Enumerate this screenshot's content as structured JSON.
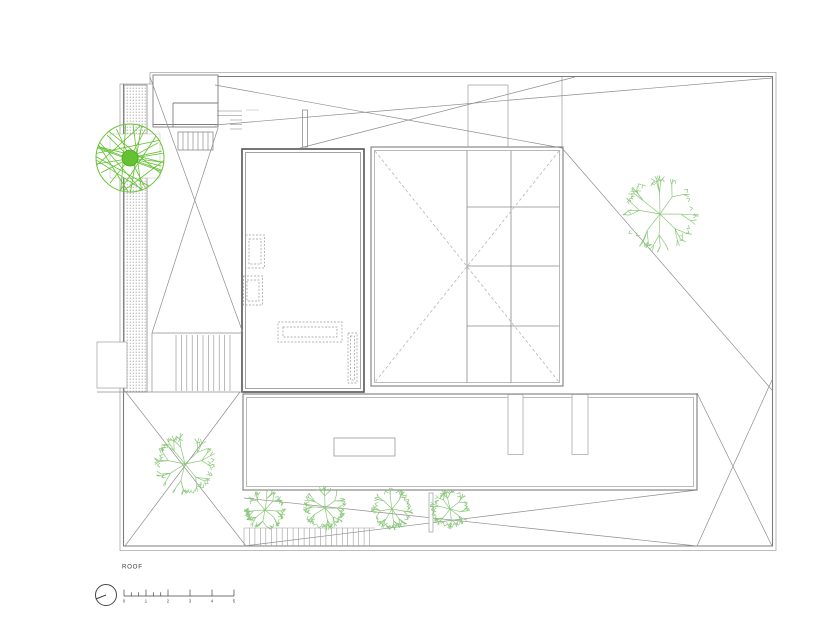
{
  "drawing": {
    "label": "ROOF"
  },
  "scale_bar": {
    "unit_labels": [
      "0",
      "1",
      "2",
      "3",
      "4",
      "5"
    ]
  },
  "colors": {
    "line_dark": "#555555",
    "line_mid": "#7d7d7d",
    "line_light": "#9e9e9e",
    "dashed": "#9a9a9a",
    "boundary": "#8f8f8f",
    "tree_branch": "#8cc87b",
    "tree_accent": "#64c231",
    "tree_accent_dark": "#4aa826",
    "hatch_dot": "#8a8a8a",
    "text": "#3a3a3a"
  },
  "trees": [
    {
      "name": "tree-accent-top-left",
      "style": "chord",
      "cx": 130,
      "cy": 158,
      "r": 34,
      "seed": 7
    },
    {
      "name": "tree-right",
      "style": "branch",
      "cx": 660,
      "cy": 214,
      "r": 38,
      "seed": 11
    },
    {
      "name": "tree-lower-left",
      "style": "branch",
      "cx": 185,
      "cy": 464,
      "r": 31,
      "seed": 23
    },
    {
      "name": "tree-row-1",
      "style": "branch",
      "cx": 265,
      "cy": 510,
      "r": 21,
      "seed": 31
    },
    {
      "name": "tree-row-2",
      "style": "branch",
      "cx": 325,
      "cy": 508,
      "r": 22,
      "seed": 37
    },
    {
      "name": "tree-row-3",
      "style": "branch",
      "cx": 392,
      "cy": 509,
      "r": 21,
      "seed": 41
    },
    {
      "name": "tree-row-4",
      "style": "branch",
      "cx": 450,
      "cy": 509,
      "r": 20,
      "seed": 43
    }
  ]
}
